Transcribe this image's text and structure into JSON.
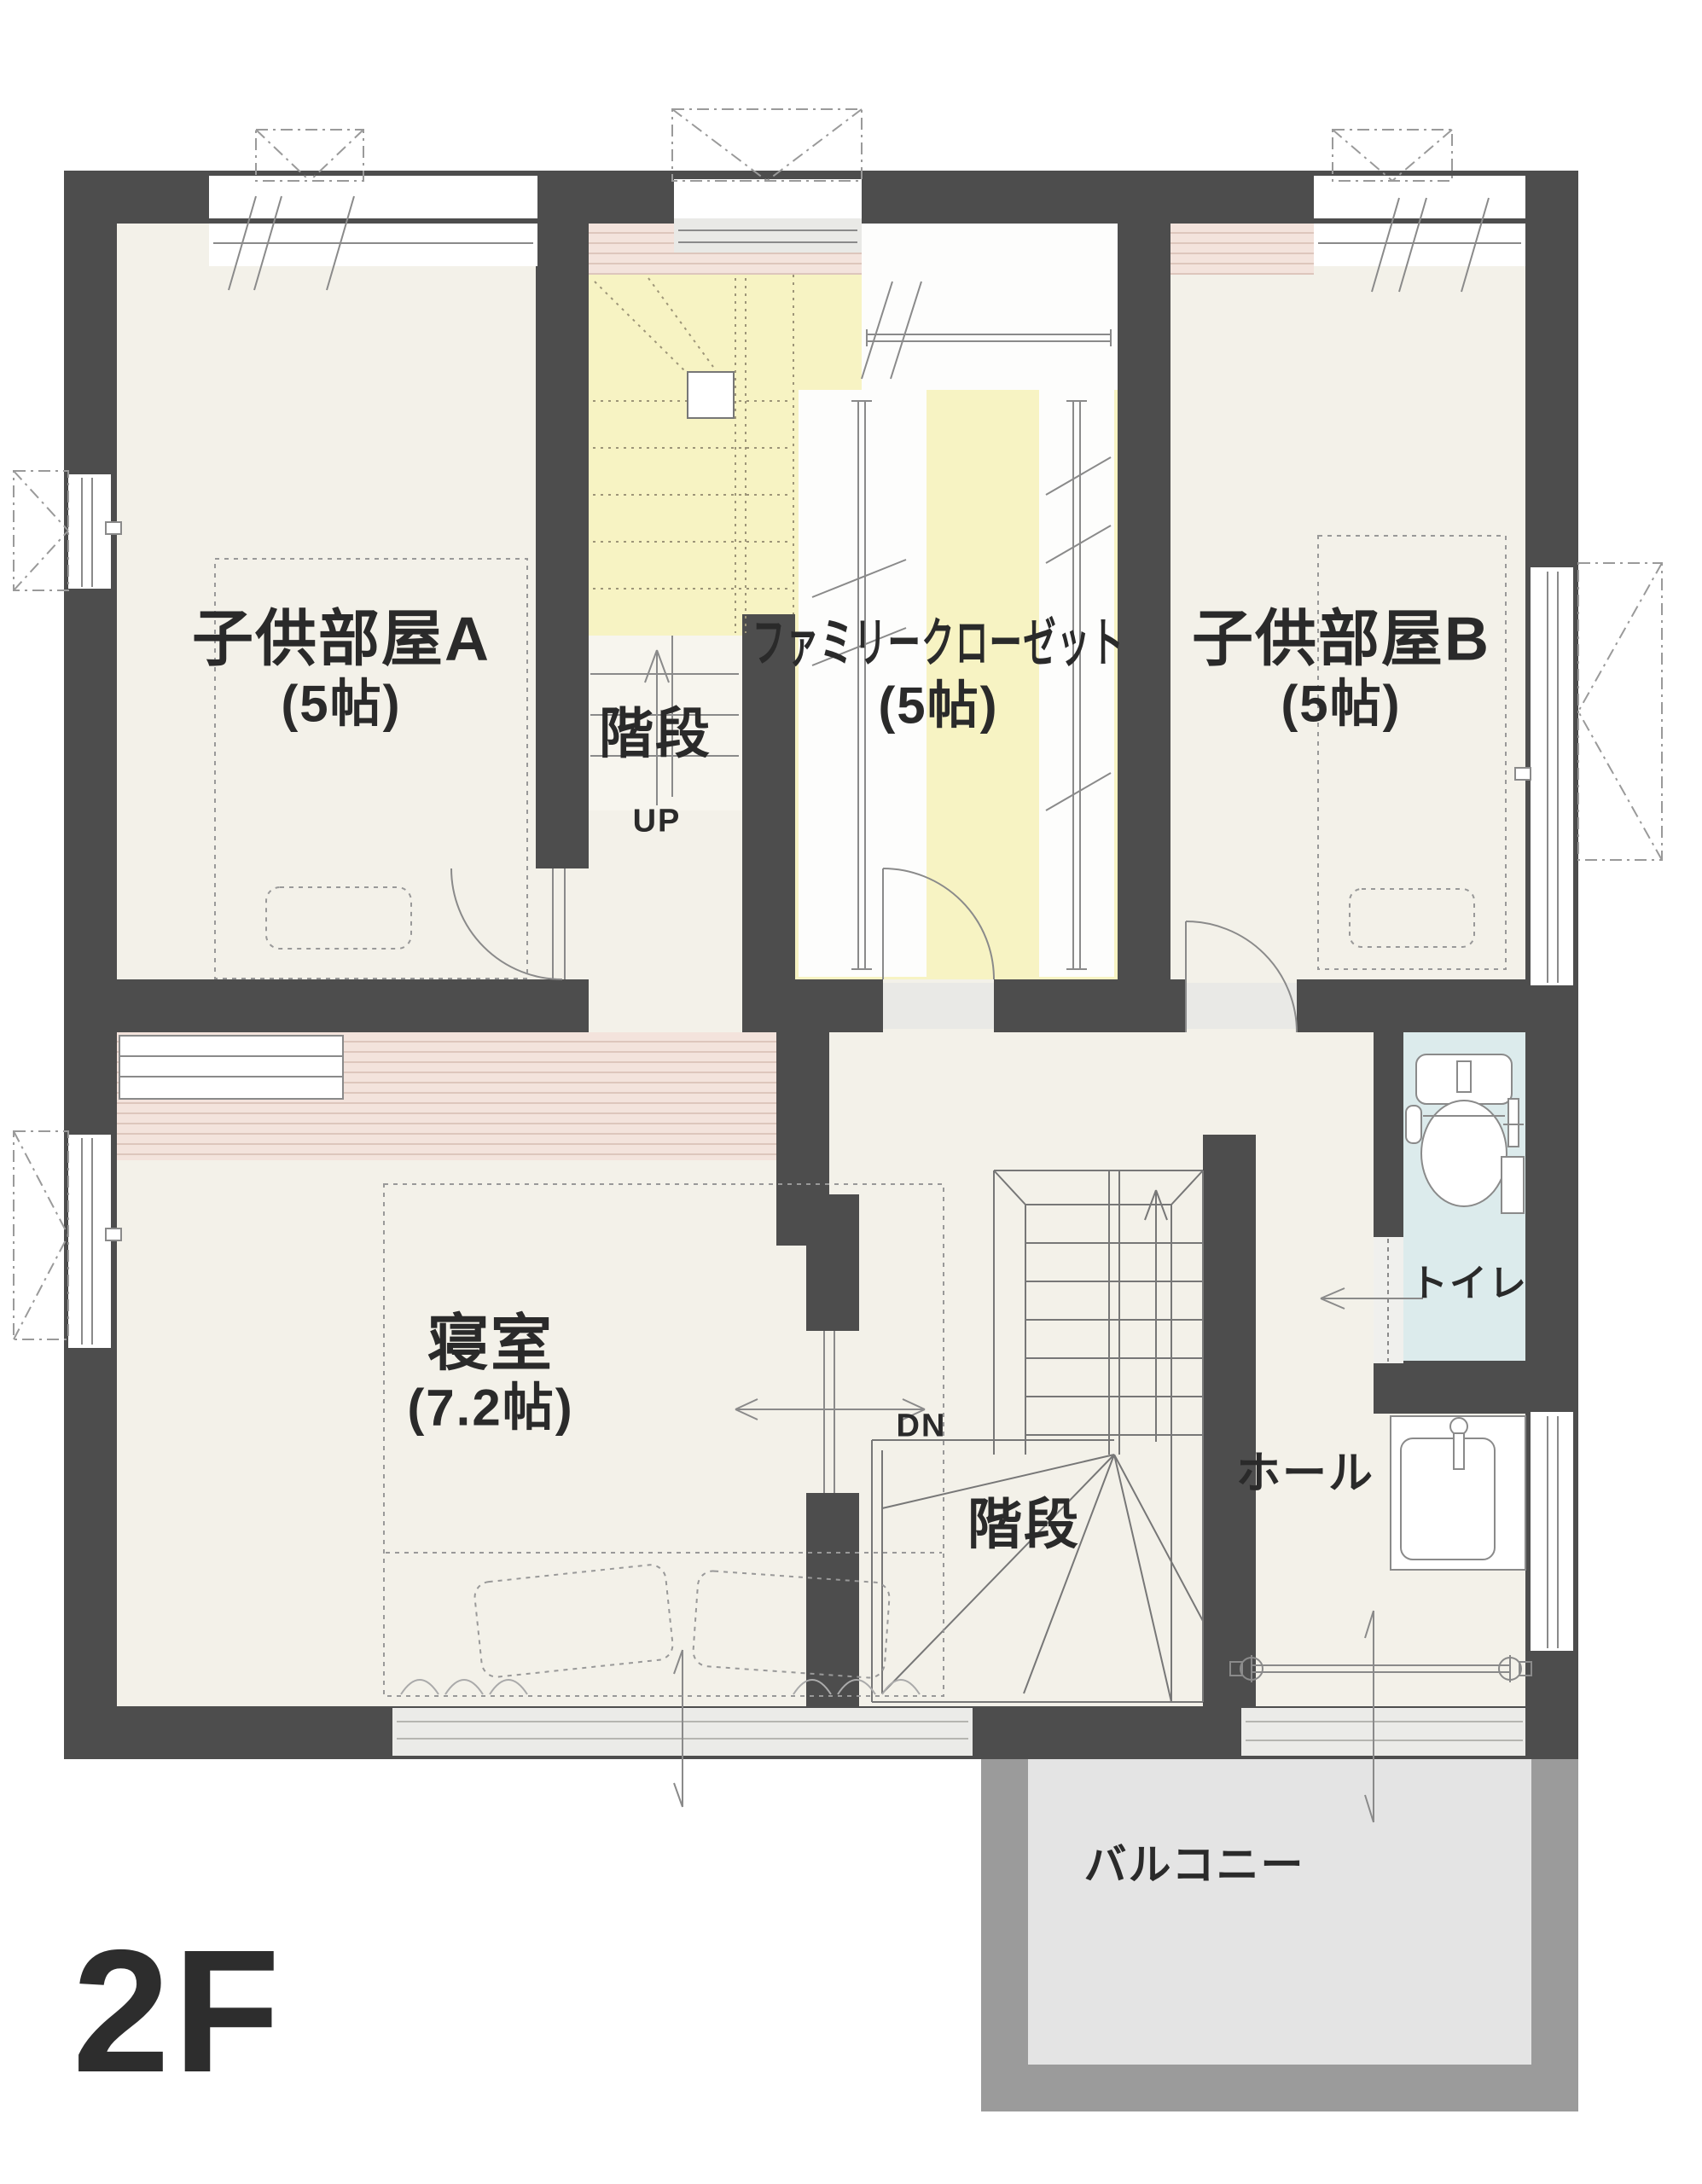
{
  "floor_label": "2F",
  "rooms": {
    "child_room_a": {
      "name": "子供部屋A",
      "size": "(5帖)"
    },
    "family_closet": {
      "name": "ファミリークローゼット",
      "size": "(5帖)"
    },
    "child_room_b": {
      "name": "子供部屋B",
      "size": "(5帖)"
    },
    "bedroom": {
      "name": "寝室",
      "size": "(7.2帖)"
    },
    "stairs_upper": {
      "name": "階段",
      "direction_label": "UP"
    },
    "stairs_lower": {
      "name": "階段",
      "direction_label": "DN"
    },
    "toilet": {
      "name": "トイレ"
    },
    "hall": {
      "name": "ホール"
    },
    "balcony": {
      "name": "バルコニー"
    }
  },
  "colors": {
    "wall": "#4d4d4d",
    "floor": "#f3f1e9",
    "stairs_closet_floor": "#f7f3c3",
    "toilet_floor": "#dcebec",
    "balcony_floor": "#e4e4e4",
    "balcony_wall": "#9b9b9b",
    "closet_shelf": "#f3e3dc",
    "shelf_stripe": "#ddc6bc",
    "line": "#8a8a8a",
    "text": "#2a2a2a"
  }
}
